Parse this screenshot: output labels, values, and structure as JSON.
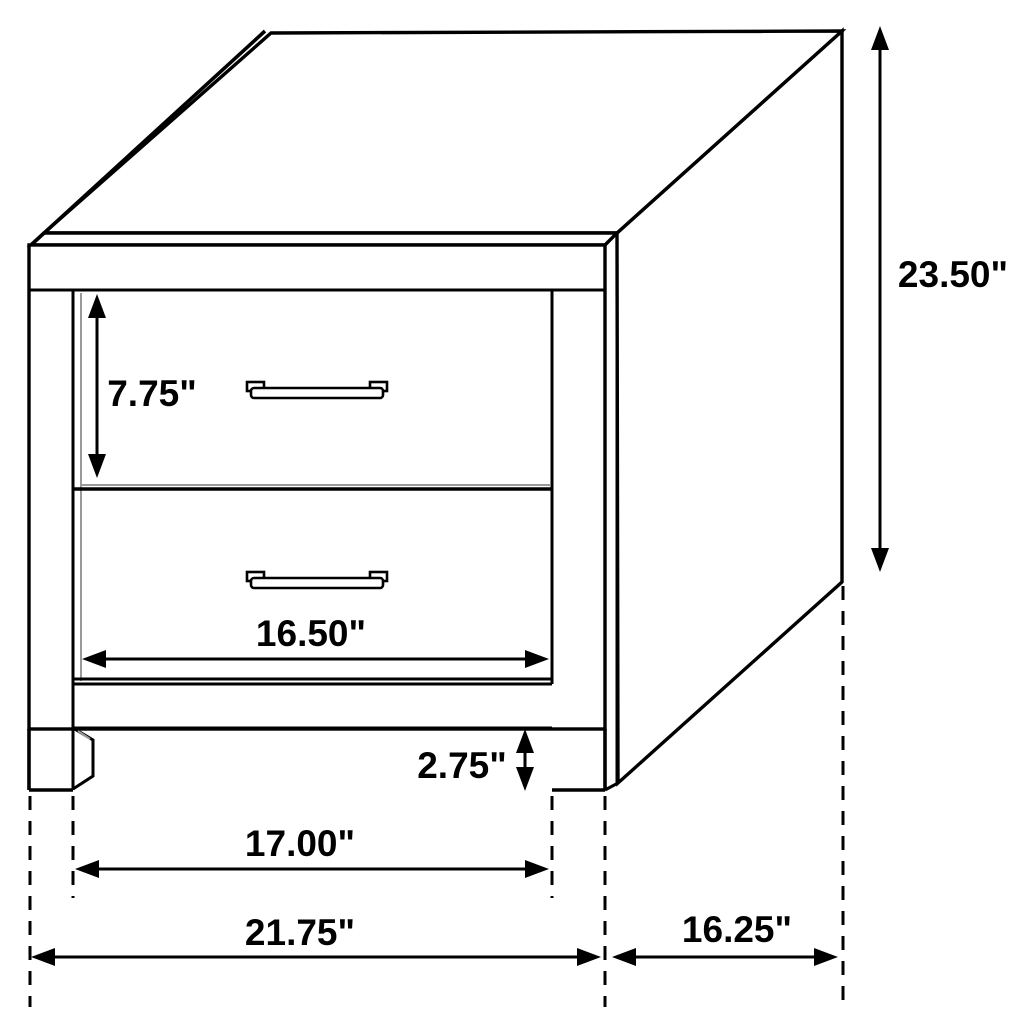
{
  "diagram": {
    "title": "Two-drawer nightstand dimensioned line drawing",
    "colors": {
      "line": "#000000",
      "background": "#ffffff",
      "shading": "#9a9a9a"
    },
    "dimensions": {
      "height": {
        "label": "23.50\"",
        "orientation": "vertical",
        "refers_to": "overall height"
      },
      "drawer_height": {
        "label": "7.75\"",
        "orientation": "vertical",
        "refers_to": "top drawer height"
      },
      "drawer_width": {
        "label": "16.50\"",
        "orientation": "horizontal",
        "refers_to": "drawer width"
      },
      "leg_height": {
        "label": "2.75\"",
        "orientation": "vertical",
        "refers_to": "leg height"
      },
      "leg_span": {
        "label": "17.00\"",
        "orientation": "horizontal",
        "refers_to": "width between legs"
      },
      "overall_width": {
        "label": "21.75\"",
        "orientation": "horizontal",
        "refers_to": "overall width"
      },
      "depth": {
        "label": "16.25\"",
        "orientation": "horizontal",
        "refers_to": "overall depth"
      }
    }
  }
}
